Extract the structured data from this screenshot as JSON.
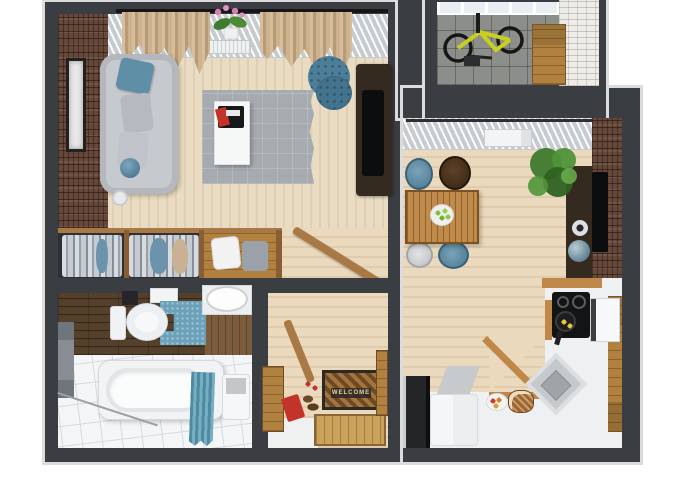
{
  "scene": {
    "type": "3d-floor-plan-top-view",
    "subject": "one-bedroom apartment 3D render, top-down"
  },
  "text": {
    "welcome_mat": "WELCOME"
  },
  "colors": {
    "wall": "#3a3d42",
    "trim": "#dcdcdc",
    "bg": "#ffffff",
    "wood_floor": "#e9dcc3",
    "wood_floor_2": "#ead9bd",
    "brick": "#66483a",
    "brick_white": "#efece7",
    "dark_wood": "#55402b",
    "wood_mid": "#a87944",
    "wood_cabinet": "#b1823f",
    "counter_wood": "#c08848",
    "teal": "#4e8ba3",
    "blue": "#5f8fa6",
    "sofa": "#c6cacf",
    "rug": "#a6abb0",
    "white_surface": "#f2f3f4",
    "balcony_floor": "#8c8e89",
    "curtain": "#c9ae88",
    "plant": "#3f7a2e",
    "bike_yellow": "#c9cf1f",
    "red": "#c2342a",
    "tv_black": "#0c0d0e",
    "console_brown": "#342a20",
    "mat_brown": "#8a5f31",
    "mat_dark": "#2c2824",
    "mat_text": "#e6d3a3",
    "tile": "#f3f5f6",
    "tile_line": "#d7dbde",
    "window_gray": "#e4e7e9"
  },
  "rooms": {
    "living_room": [
      "sofa",
      "blue-cushion",
      "gray-cushions",
      "area-rug",
      "coffee-table",
      "magazines",
      "ottoman-pouf",
      "tv-cabinet",
      "picture-frame",
      "curtains",
      "radiator",
      "orchid-plant",
      "brick-accent-wall"
    ],
    "wardrobe": [
      "hanging-clothes",
      "suitcase",
      "storage-box",
      "wood-shelf"
    ],
    "hallway": [
      "welcome-mat",
      "coat-rack",
      "shoe-bench",
      "red-box",
      "shoes",
      "wall-hooks",
      "door-threshold",
      "cabinets"
    ],
    "bathroom": [
      "bathtub",
      "shower-curtain",
      "toilet",
      "bath-mat",
      "washbasin",
      "laundry-unit",
      "towel-rail",
      "wood-wall"
    ],
    "balcony": [
      "bicycle",
      "storage-cabinet",
      "glazing",
      "tile-floor"
    ],
    "kitchen": [
      "dining-table",
      "fruit-bowl",
      "chairs",
      "potted-plant",
      "wall-tv",
      "media-cabinet",
      "speakers",
      "counter",
      "sink",
      "cooktop",
      "frying-pan",
      "oven",
      "refrigerator",
      "bread-basket",
      "fruit-plate",
      "window-blinds",
      "brick-wall"
    ]
  }
}
